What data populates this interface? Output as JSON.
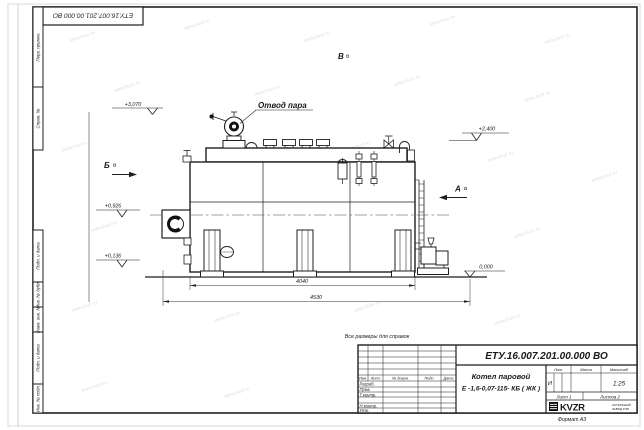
{
  "sheet": {
    "stamp_top": "ЕТУ.16.007.201.00.000  ВО",
    "format_note": "Формат А3",
    "reference_note": "Все размеры для справок"
  },
  "margin_columns": [
    "Перв. примен.",
    "Справ. №",
    "Подп. и дата",
    "Инв. № дубл.",
    "Взам. инв. №",
    "Подп. и дата",
    "Инв. № подл."
  ],
  "title_block": {
    "doc_number": "ЕТУ.16.007.201.00.000  ВО",
    "name_line1": "Котел паровой",
    "name_line2": "Е -1,6-0,07-115- КБ ( ЖК )",
    "col_izm": "Изм.",
    "col_list": "Лист",
    "col_doc": "№ докум.",
    "col_podp": "Подп.",
    "col_data": "Дата",
    "row_razrab": "Разраб.",
    "row_prov": "Пров.",
    "row_tkontr": "Т.контр.",
    "row_nkontr": "Н.контр.",
    "row_utv": "Утв.",
    "lit_label": "Лит.",
    "mass_label": "Масса",
    "scale_label": "Масштаб",
    "lit_value": "И",
    "scale_value": "1:25",
    "sheet_text": "Лист 1",
    "sheets_text": "Листов 2",
    "logo_text": "KVZR",
    "company_line1": "КОТЕЛЬНЫЙ",
    "company_line2": "ЗАВОД РЭП"
  },
  "drawing": {
    "steam_outlet_label": "Отвод пара",
    "view_a": "А",
    "view_b": "Б",
    "view_v": "В",
    "elev_top_left": "+3,070",
    "elev_right": "+2,400",
    "elev_mid_left": "+0,926",
    "elev_low_left": "+0,136",
    "elev_zero": "0,000",
    "dim_inner": "4040",
    "dim_outer": "4530"
  },
  "watermark": {
    "text": "www.kvzr.ru"
  }
}
